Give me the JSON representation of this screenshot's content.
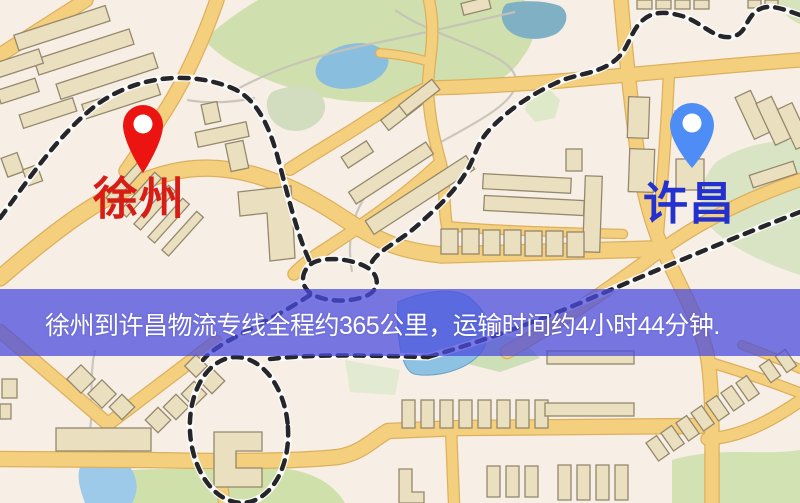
{
  "banner": {
    "text": "徐州到许昌物流专线全程约365公里，运输时间约4小时44分钟.",
    "background_color": "#4a4cdd",
    "text_color": "#ffffff"
  },
  "route": {
    "origin": "徐州",
    "destination": "许昌",
    "service": "物流专线",
    "distance_km": 365,
    "duration_text": "4小时44分钟"
  },
  "markers": {
    "origin": {
      "name": "徐州",
      "pin_color": "#ec1410",
      "label_color": "#d81d16"
    },
    "destination": {
      "name": "许昌",
      "pin_color": "#4f8df6",
      "label_color": "#2531cf"
    }
  },
  "map_palette": {
    "background": "#f7efe6",
    "road_fill": "#f4cf7d",
    "road_casing": "#ddb05e",
    "building_fill": "#eae0bf",
    "building_stroke": "#95886d",
    "park_green": "#cfdfae",
    "water_blue": "#8ec2e2",
    "railway_dark": "#26262a"
  }
}
